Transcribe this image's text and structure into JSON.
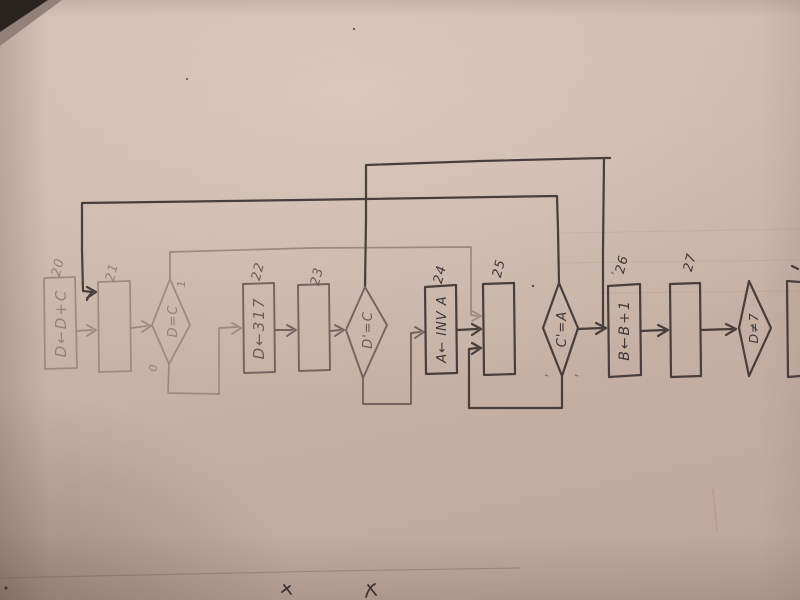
{
  "photo": {
    "paper_color": "#c9b3a7",
    "ink_dark": "#473e3d",
    "ink_medium": "#75645d",
    "ink_faint": "#9c8980",
    "table_corner_color": "#2b2624",
    "red_smudge_color": "#c08080"
  },
  "diagram": {
    "type": "flowchart",
    "orientation": "hand-drawn on paper, all text rotated 90° counter-clockwise",
    "nodes": [
      {
        "id": "b20",
        "kind": "process",
        "number": "20",
        "label": "D←D+C"
      },
      {
        "id": "b21",
        "kind": "process",
        "number": "21",
        "label": ""
      },
      {
        "id": "d1",
        "kind": "decision",
        "label": "D=C",
        "branch_true": "1",
        "branch_false": "0"
      },
      {
        "id": "b22",
        "kind": "process",
        "number": "22",
        "label": "D←317"
      },
      {
        "id": "b23",
        "kind": "process",
        "number": "23",
        "label": ""
      },
      {
        "id": "d2",
        "kind": "decision",
        "label": "D'=C"
      },
      {
        "id": "b24",
        "kind": "process",
        "number": "24",
        "label": "A← INV A"
      },
      {
        "id": "b25",
        "kind": "process",
        "number": "25",
        "label": ""
      },
      {
        "id": "d3",
        "kind": "decision",
        "label": "C'=A"
      },
      {
        "id": "b26",
        "kind": "process",
        "number": "26",
        "label": "B←B+1"
      },
      {
        "id": "b27",
        "kind": "process",
        "number": "27",
        "label": ""
      },
      {
        "id": "d4",
        "kind": "decision",
        "label": "D≠7"
      },
      {
        "id": "b28",
        "kind": "process",
        "number": "",
        "label": "",
        "partial": true
      }
    ],
    "edges": [
      {
        "from": "b20",
        "to": "b21"
      },
      {
        "from": "b21",
        "to": "d1"
      },
      {
        "from": "d1",
        "to": "b22",
        "branch": "0",
        "side": "bottom"
      },
      {
        "from": "d1",
        "to": "b25",
        "branch": "1",
        "side": "top"
      },
      {
        "from": "b22",
        "to": "b23"
      },
      {
        "from": "b23",
        "to": "d2"
      },
      {
        "from": "d2",
        "to": "b24",
        "side": "bottom"
      },
      {
        "from": "d2",
        "to": "b26",
        "side": "top"
      },
      {
        "from": "b24",
        "to": "b25"
      },
      {
        "from": "d3",
        "to": "b25",
        "side": "bottom"
      },
      {
        "from": "d3",
        "to": "b21",
        "side": "top"
      },
      {
        "from": "d3",
        "to": "b26",
        "side": "right"
      },
      {
        "from": "b26",
        "to": "b27"
      },
      {
        "from": "b27",
        "to": "d4"
      }
    ]
  }
}
